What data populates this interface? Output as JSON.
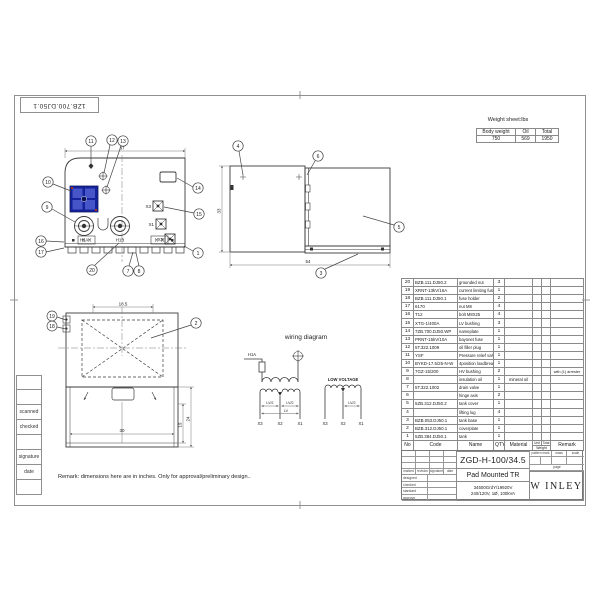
{
  "colors": {
    "switch_blue": "#16229b",
    "switch_blue_light": "#4656c8",
    "line": "#3a3a3a"
  },
  "sheet": {
    "doc_number": "1ZB.700.DJ50.1",
    "remark": "Remark: dimensions here are in inches. Only for approval/preliminary design..",
    "margin_labels": [
      "scanned",
      "checked",
      "signature",
      "date"
    ]
  },
  "weight_sheet": {
    "title": "Weight sheet:lbs",
    "columns": [
      "Body weight",
      "Oil",
      "Total"
    ],
    "values": [
      "750",
      "569",
      "1950"
    ]
  },
  "parts_table": {
    "header": {
      "no": "No",
      "code": "Code",
      "name": "Name",
      "qty": "QTY",
      "material": "Material",
      "unit": "Unit",
      "total": "Total",
      "weight": "Weight",
      "remark": "Remark"
    },
    "rows": [
      {
        "no": "20",
        "code": "BZB.111.DJ50.2",
        "name": "grounded nut",
        "qty": "3",
        "material": "",
        "remark": ""
      },
      {
        "no": "19",
        "code": "XRNT-13kV/16A",
        "name": "current limiting fuse",
        "qty": "1",
        "material": "",
        "remark": ""
      },
      {
        "no": "18",
        "code": "BZB.111.DJ50.1",
        "name": "fuse holder",
        "qty": "2",
        "material": "",
        "remark": ""
      },
      {
        "no": "17",
        "code": "6170",
        "name": "nut M8",
        "qty": "4",
        "material": "",
        "remark": ""
      },
      {
        "no": "16",
        "code": "T12",
        "name": "bolt M8X25",
        "qty": "4",
        "material": "",
        "remark": ""
      },
      {
        "no": "15",
        "code": "XTG-1/400A",
        "name": "LV bushing",
        "qty": "3",
        "material": "",
        "remark": ""
      },
      {
        "no": "14",
        "code": "7ZB.700.DJ50.WP",
        "name": "nameplate",
        "qty": "1",
        "material": "",
        "remark": ""
      },
      {
        "no": "13",
        "code": "PRNT-15kV/10A",
        "name": "bayonet fuse",
        "qty": "1",
        "material": "",
        "remark": ""
      },
      {
        "no": "12",
        "code": "5T.322.1009",
        "name": "oil filler plug",
        "qty": "1",
        "material": "",
        "remark": ""
      },
      {
        "no": "11",
        "code": "YSF",
        "name": "Pressure relief valve",
        "qty": "1",
        "material": "",
        "remark": ""
      },
      {
        "no": "10",
        "code": "BYKD-17.5/25-N-W",
        "name": "4position loadbreak",
        "qty": "1",
        "material": "",
        "remark": ""
      },
      {
        "no": "9",
        "code": "7GZ-15/200",
        "name": "HV bushing",
        "qty": "2",
        "material": "",
        "remark": "with (1) arrester"
      },
      {
        "no": "8",
        "code": "",
        "name": "insulation oil",
        "qty": "1",
        "material": "mineral oil",
        "remark": ""
      },
      {
        "no": "7",
        "code": "5T.322.1002",
        "name": "drain valve",
        "qty": "1",
        "material": "",
        "remark": ""
      },
      {
        "no": "6",
        "code": "",
        "name": "hinge axis",
        "qty": "2",
        "material": "",
        "remark": ""
      },
      {
        "no": "5",
        "code": "5ZB.312.DJ50.2",
        "name": "tank cover",
        "qty": "1",
        "material": "",
        "remark": ""
      },
      {
        "no": "4",
        "code": "",
        "name": "lifting lug",
        "qty": "4",
        "material": "",
        "remark": ""
      },
      {
        "no": "3",
        "code": "BZB.053.DJ50.1",
        "name": "tank base",
        "qty": "1",
        "material": "",
        "remark": ""
      },
      {
        "no": "2",
        "code": "BZB.312.DJ50.1",
        "name": "coverplate",
        "qty": "1",
        "material": "",
        "remark": ""
      },
      {
        "no": "1",
        "code": "5ZB.384.DJ50.1",
        "name": "tank",
        "qty": "1",
        "material": "",
        "remark": ""
      }
    ]
  },
  "title_block": {
    "drawing_no": "ZGD-H-100/34.5",
    "product_name": "Pad Mounted TR",
    "spec_line1": "34500GrdY/19920V",
    "spec_line2": "240/120V, 1Ø, 100kVA",
    "brand": "W INLEY",
    "small_headers": [
      "pattern mark",
      "mass",
      "scale"
    ],
    "page_label": "page",
    "rev_header": [
      "marked",
      "revision",
      "signature",
      "date"
    ],
    "sign_rows": [
      "designed",
      "checked",
      "standard",
      "approve"
    ]
  },
  "views": {
    "top": {
      "dim_width": "37",
      "h1a": "H1A",
      "h1b": "H1B",
      "x1": "X1",
      "x2": "X2",
      "x3": "X3",
      "callouts": {
        "c1": "1",
        "c7": "7",
        "c8": "8",
        "c9": "9",
        "c10": "10",
        "c11": "11",
        "c12": "12",
        "c13": "13",
        "c14": "14",
        "c15": "15",
        "c16": "16",
        "c17": "17",
        "c20": "20"
      }
    },
    "side": {
      "dim_width": "54",
      "dim_height": "33",
      "callouts": {
        "c3": "3",
        "c4": "4",
        "c5": "5",
        "c6": "6"
      }
    },
    "plan": {
      "dim_top": "18.5",
      "dim_bottom": "30",
      "dim_inner": "19",
      "dim_outer": "24",
      "callouts": {
        "c2": "2",
        "c18": "18",
        "c19": "19"
      }
    },
    "wiring": {
      "title": "wiring diagram",
      "hv_terminal": "H1A",
      "low_voltage": "LOW VOLTAGE",
      "lv_half": "LV/2",
      "lv": "LV",
      "x1": "X1",
      "x2": "X2",
      "x3": "X3"
    }
  }
}
